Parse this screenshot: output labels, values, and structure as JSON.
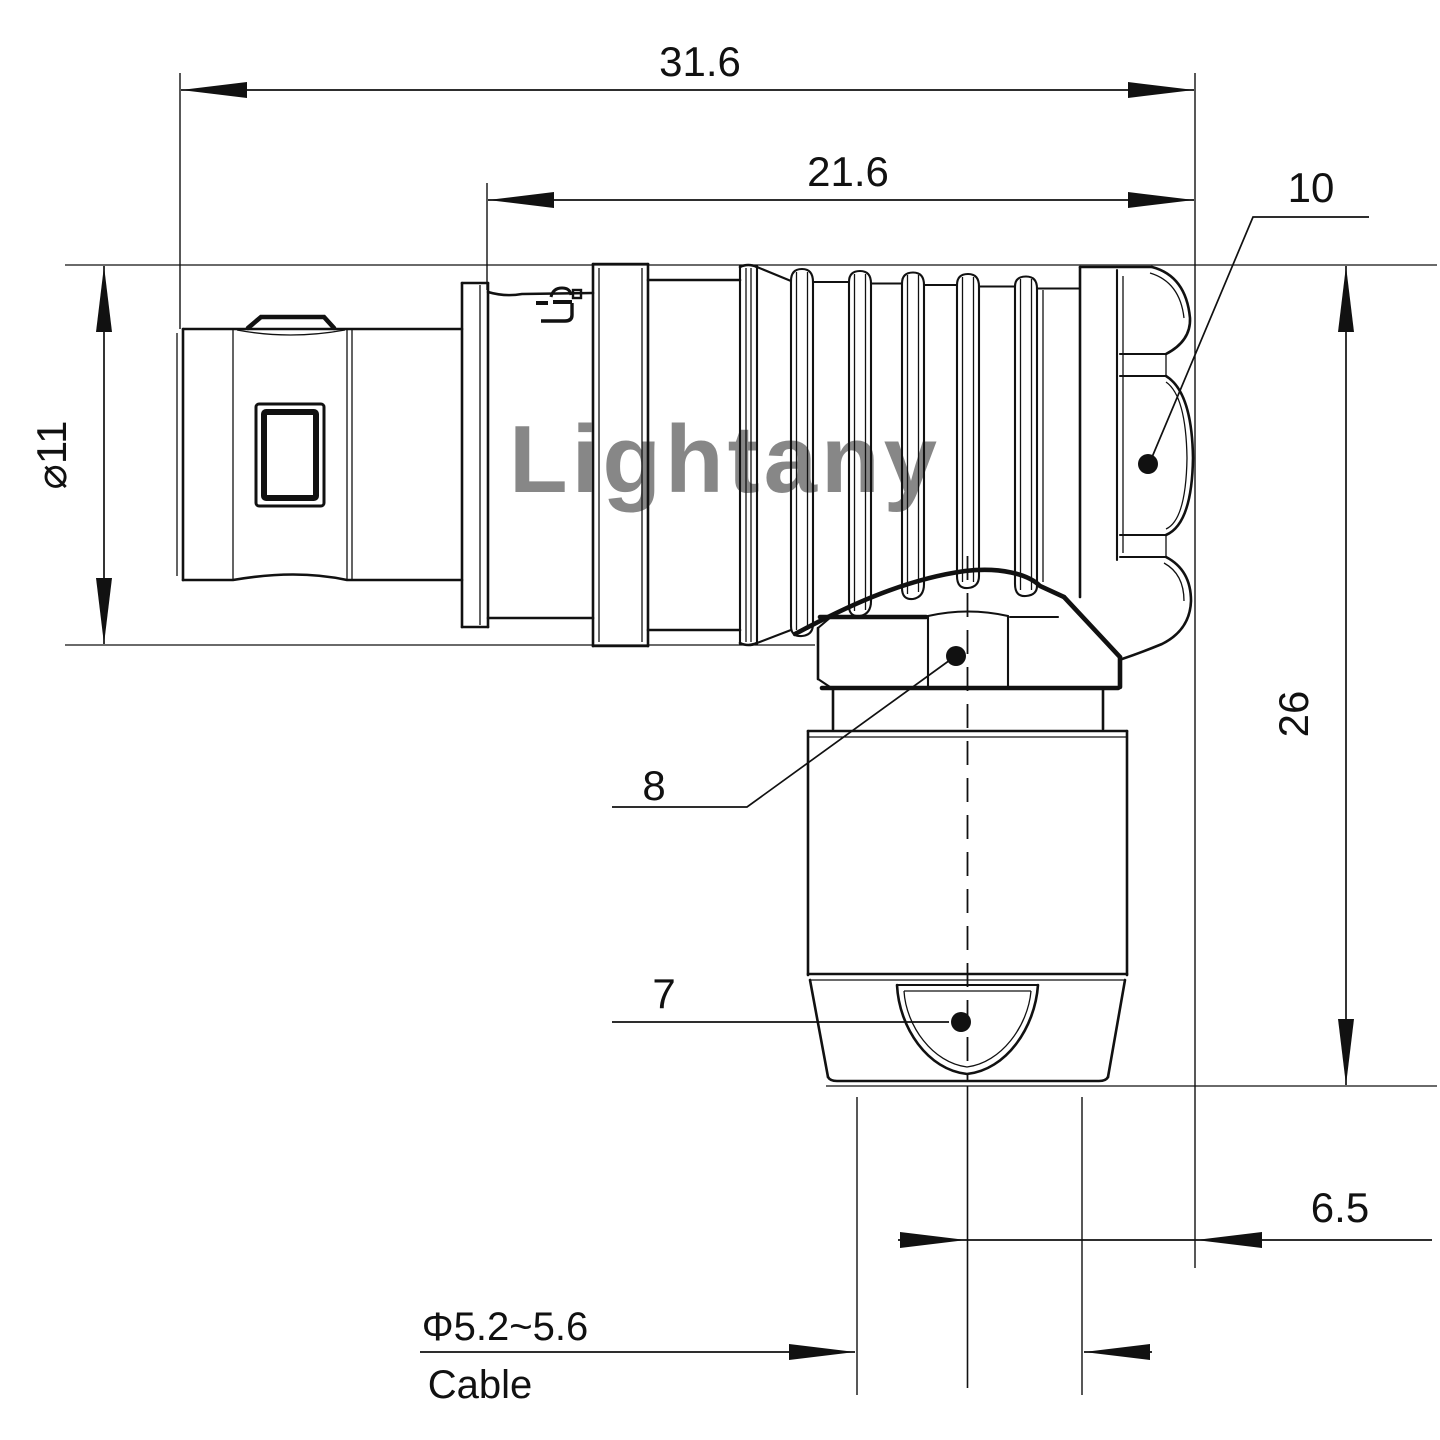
{
  "drawing": {
    "watermark": {
      "text": "Lightany",
      "color": "#e8a8a8"
    },
    "colors": {
      "line": "#111111",
      "background": "#ffffff"
    },
    "dimensions": {
      "overall_length": {
        "label": "31.6"
      },
      "shell_length": {
        "label": "21.6"
      },
      "coupling_nut_callout": {
        "label": "10"
      },
      "plug_diameter": {
        "label": "⌀11"
      },
      "elbow_height": {
        "label": "26"
      },
      "hex_nut_callout": {
        "label": "8"
      },
      "boot_callout": {
        "label": "7"
      },
      "axis_to_face_offset": {
        "label": "6.5"
      },
      "cable_diameter": {
        "label": "Φ5.2~5.6"
      },
      "cable_caption": {
        "label": "Cable"
      }
    }
  }
}
